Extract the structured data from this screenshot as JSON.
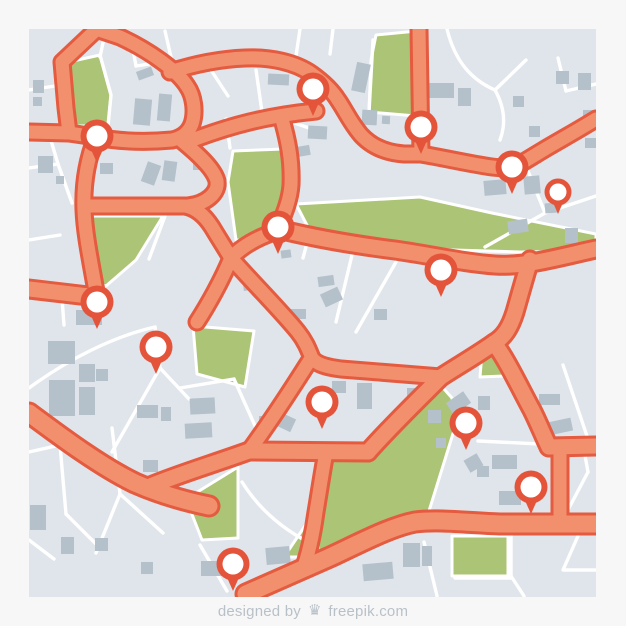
{
  "page": {
    "background": "#f7f7f8",
    "footer": {
      "designed_by": "designed by",
      "brand": "freepik.com",
      "logo_icon": "freepik-crown-icon",
      "logo_glyph": "♛",
      "text_color": "#b9c1c8"
    }
  },
  "map": {
    "x": 29,
    "y": 29,
    "width": 567,
    "height": 568,
    "colors": {
      "background": "#dfe5ea",
      "street": "#ffffff",
      "road_fill": "#F2906E",
      "road_casing": "#E45B40",
      "park": "#ACC475",
      "park_edge": "#ffffff",
      "building": "#B4C0CA",
      "pin_ring": "#E4543A",
      "pin_fill": "#ffffff"
    },
    "road_widths": {
      "a": 13,
      "b": 15,
      "c": 17,
      "casing_extra": 6
    },
    "roads": [
      {
        "id": "corner-road",
        "w": "a",
        "d": "M97,29 L62,62 L66,108 L69,133"
      },
      {
        "id": "hook-road",
        "w": "a",
        "d": "M29,132 L69,133 L96,137 C122,142 150,142 172,140 C182,138 189,132 192,124 C196,112 194,96 187,86 C177,70 148,50 120,37 L96,29"
      },
      {
        "id": "north-arterial",
        "w": "a",
        "d": "M170,72 C195,64 220,59 245,58 C270,57 295,62 312,74 C326,84 333,92 338,100 C345,110 350,122 361,135 C373,148 389,153 404,154 L421,154 C445,158 470,164 492,167 C500,168 507,168 513,168 C524,162 535,155 545,149 C562,139 580,129 596,119"
      },
      {
        "id": "hook-diagonal",
        "w": "a",
        "d": "M195,139 C230,126 265,116 316,111"
      },
      {
        "id": "park-road",
        "w": "a",
        "d": "M281,116 C288,140 292,160 291,185 C290,200 284,214 278,229"
      },
      {
        "id": "mid-arterial",
        "w": "b",
        "d": "M278,229 C315,238 355,245 395,250 C430,255 465,263 495,265 C525,267 555,258 596,249"
      },
      {
        "id": "v1-upper",
        "w": "b",
        "d": "M530,260 C524,280 519,298 515,312 C510,328 504,337 494,343"
      },
      {
        "id": "v1-to-j2",
        "w": "b",
        "d": "M494,343 C477,355 458,366 441,377"
      },
      {
        "id": "v1-to-t",
        "w": "b",
        "d": "M494,343 C506,358 520,388 532,410 C539,424 544,437 549,447"
      },
      {
        "id": "t-horizontal",
        "w": "b",
        "d": "M549,447 L596,446"
      },
      {
        "id": "t-vertical",
        "w": "a",
        "d": "M560,447 L560,523"
      },
      {
        "id": "j2-left",
        "w": "b",
        "d": "M441,377 C421,397 391,426 368,452"
      },
      {
        "id": "j3-horizontal",
        "w": "b",
        "d": "M368,452 L249,451"
      },
      {
        "id": "j1-up",
        "w": "a",
        "d": "M249,451 C268,425 291,390 310,360"
      },
      {
        "id": "cross-road-p",
        "w": "a",
        "d": "M231,258 C252,282 282,312 298,332 C306,342 309,351 312,358 C316,364 326,367 341,369 L441,377"
      },
      {
        "id": "cross-road-q",
        "w": "a",
        "d": "M277,231 C259,237 242,246 231,258 C222,280 208,305 197,322"
      },
      {
        "id": "west-road",
        "w": "b",
        "d": "M29,289 L97,297"
      },
      {
        "id": "curvy-vertical",
        "w": "a",
        "d": "M96,137 C87,160 83,185 84,210 C85,235 91,262 97,297"
      },
      {
        "id": "left-horizontal",
        "w": "a",
        "d": "M87,206 L185,206 C196,208 205,216 212,227 C218,237 225,248 231,258"
      },
      {
        "id": "s-curve",
        "w": "a",
        "d": "M182,141 C199,155 214,169 217,181 C219,193 206,204 188,206"
      },
      {
        "id": "sw-diagonal",
        "w": "c",
        "d": "M29,413 C60,436 100,466 135,483 C160,494 185,501 209,506"
      },
      {
        "id": "sw-branch",
        "w": "b",
        "d": "M148,487 C176,475 216,463 249,451"
      },
      {
        "id": "south-arterial",
        "w": "c",
        "d": "M246,594 L330,557 C360,543 390,527 415,522 C440,519 470,523 500,524 L596,524"
      },
      {
        "id": "v2-road",
        "w": "a",
        "d": "M326,452 C322,474 319,494 316,512 C313,534 308,556 303,569"
      },
      {
        "id": "top-vertical",
        "w": "a",
        "d": "M419,29 L421,154"
      }
    ],
    "streets": [
      "M104,38 L100,57",
      "M100,55 L111,95 L108,126",
      "M29,90 L55,86",
      "M29,168 L58,164",
      "M58,164 L50,137",
      "M58,164 L72,203",
      "M130,33 L136,66",
      "M136,66 L162,62",
      "M165,31 L171,57",
      "M207,64 L228,96",
      "M256,70 L262,112",
      "M262,112 L318,131",
      "M300,29 L296,56",
      "M333,29 L330,54",
      "M369,112 L373,40",
      "M447,29 C455,62 472,80 495,90",
      "M495,90 L526,60",
      "M495,90 C505,108 506,124 500,140",
      "M596,84 L566,91",
      "M566,91 L558,58",
      "M485,247 L545,213 L596,196",
      "M545,213 L528,171",
      "M352,255 L336,322",
      "M396,262 L356,332",
      "M165,216 L149,259",
      "M230,148 L226,119",
      "M310,232 L303,258",
      "M180,388 L234,379",
      "M234,379 L256,428",
      "M29,388 C70,358 115,336 155,327",
      "M155,327 L160,368",
      "M160,368 L112,452",
      "M160,368 L189,399",
      "M62,298 L64,325",
      "M60,445 L29,452",
      "M60,445 L66,514",
      "M66,514 L99,547",
      "M112,428 L120,494",
      "M120,494 L96,553",
      "M120,494 L163,533",
      "M200,545 L227,591",
      "M29,540 L54,559",
      "M242,482 C262,514 290,534 318,547",
      "M424,542 L437,596",
      "M578,536 L563,570 L596,570",
      "M511,536 L511,576 L524,596",
      "M455,578 L511,578",
      "M584,450 L588,472",
      "M588,472 L569,508",
      "M563,365 L589,442",
      "M478,441 L540,444",
      "M29,240 L60,235"
    ],
    "parks": [
      {
        "id": "park-nw",
        "points": "64,63 100,55 111,95 108,126 66,126"
      },
      {
        "id": "park-top",
        "points": "376,35 417,31 416,116 369,112 371,60"
      },
      {
        "id": "park-west",
        "points": "86,216 163,216 136,260 106,286 90,282"
      },
      {
        "id": "park-center",
        "points": "233,151 284,149 292,180 280,218 276,229 262,242 236,240 228,182"
      },
      {
        "id": "park-strip",
        "points": "296,204 420,197 492,213 596,234 596,251 520,252 420,249 311,233"
      },
      {
        "id": "park-south-big",
        "points": "331,458 366,455 437,381 452,398 456,424 429,511 415,517 331,556 307,566 316,507 322,462"
      },
      {
        "id": "park-south-sliver",
        "points": "284,557 317,508 318,557"
      },
      {
        "id": "park-sw",
        "points": "186,499 238,467 238,538 202,540"
      },
      {
        "id": "park-west-mid",
        "points": "193,326 254,331 245,387 197,374"
      },
      {
        "id": "park-south-square",
        "points": "452,536 508,536 508,576 452,576"
      },
      {
        "id": "park-east-small",
        "points": "482,352 508,358 504,376 480,377"
      }
    ],
    "buildings": [
      {
        "x": 137,
        "y": 69,
        "w": 16,
        "h": 9,
        "r": -20
      },
      {
        "x": 134,
        "y": 99,
        "w": 17,
        "h": 26,
        "r": 5
      },
      {
        "x": 158,
        "y": 94,
        "w": 13,
        "h": 27,
        "r": 5
      },
      {
        "x": 193,
        "y": 158,
        "w": 14,
        "h": 12,
        "r": 0
      },
      {
        "x": 33,
        "y": 80,
        "w": 11,
        "h": 13,
        "r": 0
      },
      {
        "x": 33,
        "y": 97,
        "w": 9,
        "h": 9,
        "r": 0
      },
      {
        "x": 146,
        "y": 48,
        "w": 11,
        "h": 6,
        "r": -15
      },
      {
        "x": 38,
        "y": 156,
        "w": 15,
        "h": 17,
        "r": 0
      },
      {
        "x": 56,
        "y": 176,
        "w": 8,
        "h": 8,
        "r": 0
      },
      {
        "x": 100,
        "y": 163,
        "w": 13,
        "h": 11,
        "r": 0
      },
      {
        "x": 144,
        "y": 163,
        "w": 14,
        "h": 21,
        "r": 20
      },
      {
        "x": 163,
        "y": 161,
        "w": 13,
        "h": 20,
        "r": 8
      },
      {
        "x": 268,
        "y": 74,
        "w": 21,
        "h": 11,
        "r": 3
      },
      {
        "x": 288,
        "y": 108,
        "w": 16,
        "h": 12,
        "r": 3
      },
      {
        "x": 308,
        "y": 126,
        "w": 19,
        "h": 13,
        "r": 3
      },
      {
        "x": 354,
        "y": 63,
        "w": 14,
        "h": 29,
        "r": 12
      },
      {
        "x": 362,
        "y": 110,
        "w": 15,
        "h": 15,
        "r": 3
      },
      {
        "x": 382,
        "y": 116,
        "w": 8,
        "h": 8,
        "r": 3
      },
      {
        "x": 428,
        "y": 83,
        "w": 26,
        "h": 15,
        "r": 0
      },
      {
        "x": 458,
        "y": 88,
        "w": 13,
        "h": 18,
        "r": 0
      },
      {
        "x": 513,
        "y": 96,
        "w": 11,
        "h": 11,
        "r": 0
      },
      {
        "x": 529,
        "y": 126,
        "w": 11,
        "h": 11,
        "r": 0
      },
      {
        "x": 556,
        "y": 71,
        "w": 13,
        "h": 13,
        "r": 0
      },
      {
        "x": 578,
        "y": 73,
        "w": 13,
        "h": 17,
        "r": 0
      },
      {
        "x": 583,
        "y": 110,
        "w": 14,
        "h": 10,
        "r": 0
      },
      {
        "x": 585,
        "y": 138,
        "w": 12,
        "h": 10,
        "r": 0
      },
      {
        "x": 484,
        "y": 180,
        "w": 22,
        "h": 15,
        "r": -5
      },
      {
        "x": 524,
        "y": 176,
        "w": 16,
        "h": 18,
        "r": -5
      },
      {
        "x": 545,
        "y": 203,
        "w": 12,
        "h": 10,
        "r": -5
      },
      {
        "x": 565,
        "y": 228,
        "w": 13,
        "h": 15,
        "r": 0
      },
      {
        "x": 508,
        "y": 220,
        "w": 20,
        "h": 13,
        "r": -8
      },
      {
        "x": 296,
        "y": 146,
        "w": 14,
        "h": 10,
        "r": -10
      },
      {
        "x": 322,
        "y": 290,
        "w": 19,
        "h": 14,
        "r": -25
      },
      {
        "x": 243,
        "y": 278,
        "w": 15,
        "h": 12,
        "r": -8
      },
      {
        "x": 281,
        "y": 250,
        "w": 10,
        "h": 8,
        "r": -8
      },
      {
        "x": 318,
        "y": 276,
        "w": 16,
        "h": 10,
        "r": -8
      },
      {
        "x": 374,
        "y": 309,
        "w": 13,
        "h": 11,
        "r": 0
      },
      {
        "x": 291,
        "y": 309,
        "w": 15,
        "h": 10,
        "r": 0
      },
      {
        "x": 190,
        "y": 398,
        "w": 25,
        "h": 16,
        "r": -3
      },
      {
        "x": 185,
        "y": 423,
        "w": 27,
        "h": 15,
        "r": -3
      },
      {
        "x": 259,
        "y": 416,
        "w": 9,
        "h": 8,
        "r": 0
      },
      {
        "x": 276,
        "y": 415,
        "w": 18,
        "h": 14,
        "r": 25
      },
      {
        "x": 332,
        "y": 381,
        "w": 14,
        "h": 12,
        "r": 0
      },
      {
        "x": 357,
        "y": 383,
        "w": 15,
        "h": 26,
        "r": 0
      },
      {
        "x": 407,
        "y": 388,
        "w": 10,
        "h": 10,
        "r": 0
      },
      {
        "x": 428,
        "y": 410,
        "w": 13,
        "h": 13,
        "r": 0
      },
      {
        "x": 448,
        "y": 396,
        "w": 21,
        "h": 14,
        "r": -35
      },
      {
        "x": 436,
        "y": 438,
        "w": 10,
        "h": 10,
        "r": 0
      },
      {
        "x": 466,
        "y": 456,
        "w": 15,
        "h": 14,
        "r": -30
      },
      {
        "x": 492,
        "y": 455,
        "w": 25,
        "h": 14,
        "r": 0
      },
      {
        "x": 499,
        "y": 491,
        "w": 22,
        "h": 14,
        "r": 0
      },
      {
        "x": 539,
        "y": 394,
        "w": 21,
        "h": 11,
        "r": 0
      },
      {
        "x": 548,
        "y": 420,
        "w": 24,
        "h": 13,
        "r": -12
      },
      {
        "x": 477,
        "y": 466,
        "w": 12,
        "h": 11,
        "r": 0
      },
      {
        "x": 478,
        "y": 396,
        "w": 12,
        "h": 14,
        "r": 0
      },
      {
        "x": 48,
        "y": 341,
        "w": 27,
        "h": 23,
        "r": 0
      },
      {
        "x": 49,
        "y": 380,
        "w": 26,
        "h": 36,
        "r": 0
      },
      {
        "x": 79,
        "y": 364,
        "w": 16,
        "h": 18,
        "r": 0
      },
      {
        "x": 79,
        "y": 387,
        "w": 16,
        "h": 28,
        "r": 0
      },
      {
        "x": 96,
        "y": 369,
        "w": 12,
        "h": 12,
        "r": 0
      },
      {
        "x": 76,
        "y": 310,
        "w": 26,
        "h": 15,
        "r": 0
      },
      {
        "x": 137,
        "y": 405,
        "w": 21,
        "h": 13,
        "r": 0
      },
      {
        "x": 161,
        "y": 407,
        "w": 10,
        "h": 14,
        "r": 0
      },
      {
        "x": 143,
        "y": 460,
        "w": 15,
        "h": 12,
        "r": 0
      },
      {
        "x": 30,
        "y": 505,
        "w": 16,
        "h": 25,
        "r": 0
      },
      {
        "x": 61,
        "y": 537,
        "w": 13,
        "h": 17,
        "r": 0
      },
      {
        "x": 95,
        "y": 538,
        "w": 13,
        "h": 13,
        "r": 0
      },
      {
        "x": 141,
        "y": 562,
        "w": 12,
        "h": 12,
        "r": 0
      },
      {
        "x": 201,
        "y": 561,
        "w": 21,
        "h": 15,
        "r": 0
      },
      {
        "x": 266,
        "y": 547,
        "w": 24,
        "h": 17,
        "r": -5
      },
      {
        "x": 403,
        "y": 543,
        "w": 17,
        "h": 24,
        "r": 0
      },
      {
        "x": 422,
        "y": 546,
        "w": 10,
        "h": 20,
        "r": 0
      },
      {
        "x": 363,
        "y": 563,
        "w": 30,
        "h": 17,
        "r": -5
      }
    ],
    "pins": [
      {
        "id": "pin-1",
        "x": 313,
        "y": 89,
        "size": "large"
      },
      {
        "id": "pin-2",
        "x": 421,
        "y": 127,
        "size": "large"
      },
      {
        "id": "pin-3",
        "x": 512,
        "y": 167,
        "size": "large"
      },
      {
        "id": "pin-4",
        "x": 558,
        "y": 192,
        "size": "small"
      },
      {
        "id": "pin-5",
        "x": 97,
        "y": 136,
        "size": "large"
      },
      {
        "id": "pin-6",
        "x": 278,
        "y": 227,
        "size": "large"
      },
      {
        "id": "pin-7",
        "x": 441,
        "y": 270,
        "size": "large"
      },
      {
        "id": "pin-8",
        "x": 97,
        "y": 302,
        "size": "large"
      },
      {
        "id": "pin-9",
        "x": 156,
        "y": 347,
        "size": "large"
      },
      {
        "id": "pin-10",
        "x": 322,
        "y": 402,
        "size": "large"
      },
      {
        "id": "pin-11",
        "x": 466,
        "y": 423,
        "size": "large"
      },
      {
        "id": "pin-12",
        "x": 531,
        "y": 487,
        "size": "large"
      },
      {
        "id": "pin-13",
        "x": 233,
        "y": 564,
        "size": "large"
      }
    ],
    "pin_geometry": {
      "large": {
        "outer_r": 16.5,
        "inner_r": 10.5,
        "tail_half": 8,
        "tail_top": 9,
        "tail_len": 27
      },
      "small": {
        "outer_r": 13.5,
        "inner_r": 8.5,
        "tail_half": 6.5,
        "tail_top": 7,
        "tail_len": 22
      }
    }
  }
}
